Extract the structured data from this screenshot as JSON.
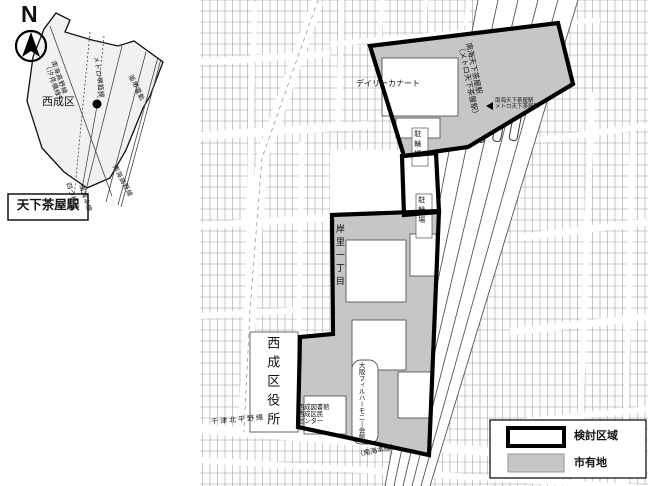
{
  "compass": {
    "label": "N"
  },
  "inset": {
    "ward_label": "西成区",
    "station_box_label": "天下茶屋駅",
    "rail_labels": {
      "koya_line1": "南海高野線",
      "koya_line2": "（汐見橋線）",
      "sakaisuji": "メトロ堺筋線",
      "hankai": "阪堺電軌",
      "yotsubashi": "四つ橋線",
      "nankai_main": "南海本線",
      "koya_south": "南海高野線"
    }
  },
  "main_map": {
    "supermarket": "デイリーカナート",
    "bicycle_parking_north": "駐輪場",
    "bicycle_parking_south": "駐輪場",
    "station_rail_label1": "南海天下茶屋駅",
    "station_rail_label2": "（メトロ天下茶屋駅）",
    "station_callout1": "南海天下茶屋駅",
    "station_callout2": "メトロ天下茶屋駅",
    "district_label": "岸里一丁目",
    "ward_office": "西成区役所",
    "phil_hall": "大阪フィルハーモニー会館",
    "library_line1": "西成図書館",
    "library_line2": "西成区民",
    "library_line3": "センター",
    "road_label": "千津北平野線",
    "rail_line_label": "（南海本線）"
  },
  "legend": {
    "study_area": "検討区域",
    "city_owned_land": "市有地"
  },
  "colors": {
    "city_land_fill": "#c6c6c6",
    "boundary": "#000000"
  }
}
